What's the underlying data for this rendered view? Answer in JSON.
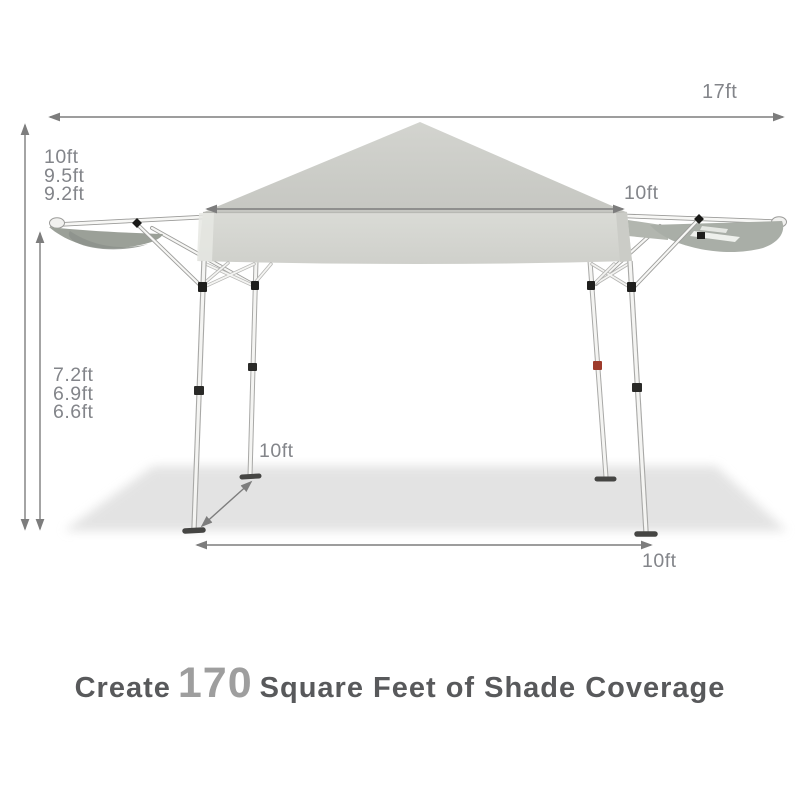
{
  "product": "pop-up canopy tent with awnings",
  "dims": {
    "total_width": "17ft",
    "peak_heights": [
      "10ft",
      "9.5ft",
      "9.2ft"
    ],
    "canopy_width": "10ft",
    "eave_heights": [
      "7.2ft",
      "6.9ft",
      "6.6ft"
    ],
    "leg_depth": "10ft",
    "leg_width": "10ft"
  },
  "caption": {
    "prefix": "Create",
    "highlight": "170",
    "suffix": "Square Feet of Shade Coverage"
  },
  "colors": {
    "background": "#ffffff",
    "canopy_top": "#cbccc7",
    "valance": "#d5d6d2",
    "awning_fabric": "#9ba098",
    "awning_underside": "#a9aea7",
    "frame_white": "#f4f4f2",
    "frame_outline": "#a8a8a6",
    "hardware_black": "#1f1f1d",
    "hardware_red": "#9e3b2b",
    "ground_shadow": "#e2e2e2",
    "dimension_line": "#7d7d7d",
    "dimension_text": "#83858a",
    "caption_text": "#58595b",
    "caption_highlight": "#9e9e9e"
  }
}
